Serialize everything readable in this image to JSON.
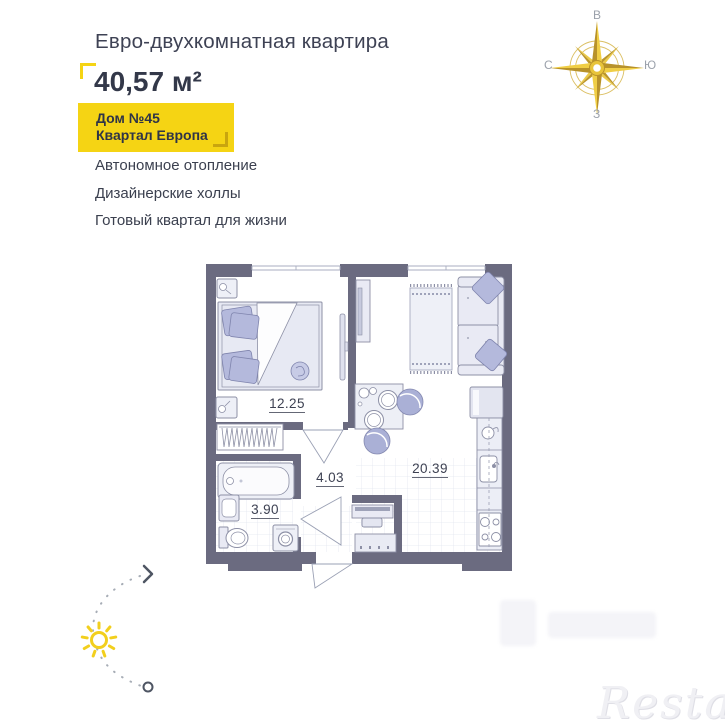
{
  "header": {
    "title": "Евро-двухкомнатная квартира",
    "area_value": "40,57 м²",
    "badge": {
      "line1": "Дом №45",
      "line2": "Квартал Европа"
    },
    "features": [
      "Автономное отопление",
      "Дизайнерские холлы",
      "Готовый квартал для жизни"
    ]
  },
  "compass": {
    "labels": {
      "top": "В",
      "right": "Ю",
      "bottom": "З",
      "left": "С"
    }
  },
  "floorplan": {
    "rooms": {
      "bedroom": {
        "area": "12.25"
      },
      "hallway": {
        "area": "4.03"
      },
      "bathroom": {
        "area": "3.90"
      },
      "kitchen_living": {
        "area": "20.39"
      }
    }
  },
  "watermark": {
    "text": "Restate"
  },
  "colors": {
    "accent_yellow": "#f5d414",
    "badge_bracket": "#c9a50e",
    "wall": "#6b6b80",
    "furniture_fill": "#e9eaf4",
    "furniture_outline": "#8d90a6",
    "cushion_lilac": "#b4b9dc",
    "compass_gold": "#e3bc31",
    "text_primary": "#3b404f"
  }
}
